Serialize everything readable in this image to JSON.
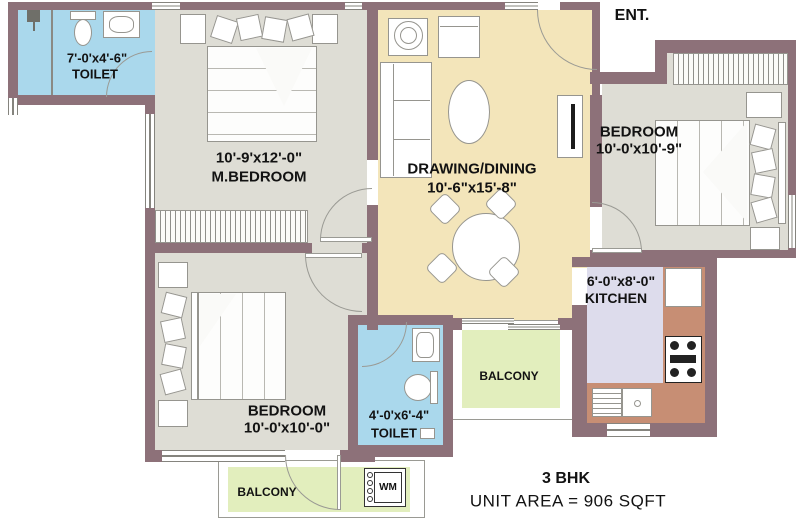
{
  "plan": {
    "entrance_label": "ENT.",
    "summary": {
      "title": "3 BHK",
      "unit_area": "UNIT AREA = 906 SQFT"
    },
    "rooms": {
      "toilet_top": {
        "dims": "7'-0'x4'-6\"",
        "name": "TOILET"
      },
      "master_bedroom": {
        "dims": "10'-9'x12'-0\"",
        "name": "M.BEDROOM"
      },
      "drawing_dining": {
        "name": "DRAWING/DINING",
        "dims": "10'-6\"x15'-8\""
      },
      "bedroom_right": {
        "name": "BEDROOM",
        "dims": "10'-0'x10'-9\""
      },
      "kitchen": {
        "dims": "6'-0\"x8'-0\"",
        "name": "KITCHEN"
      },
      "balcony_mid": {
        "name": "BALCONY"
      },
      "bedroom_bottom": {
        "name": "BEDROOM",
        "dims": "10'-0'x10'-0\""
      },
      "toilet_bottom": {
        "dims": "4'-0'x6'-4\"",
        "name": "TOILET"
      },
      "balcony_bottom": {
        "name": "BALCONY"
      }
    },
    "appliances": {
      "washing_machine": "WM"
    },
    "colors": {
      "wall": "#8d7179",
      "toilet_floor": "#aad8ec",
      "bedroom_floor": "#deddd5",
      "living_floor": "#f3e5ba",
      "kitchen_floor": "#dddcec",
      "kitchen_counter": "#c78e74",
      "balcony_floor": "#e2eebd"
    }
  }
}
